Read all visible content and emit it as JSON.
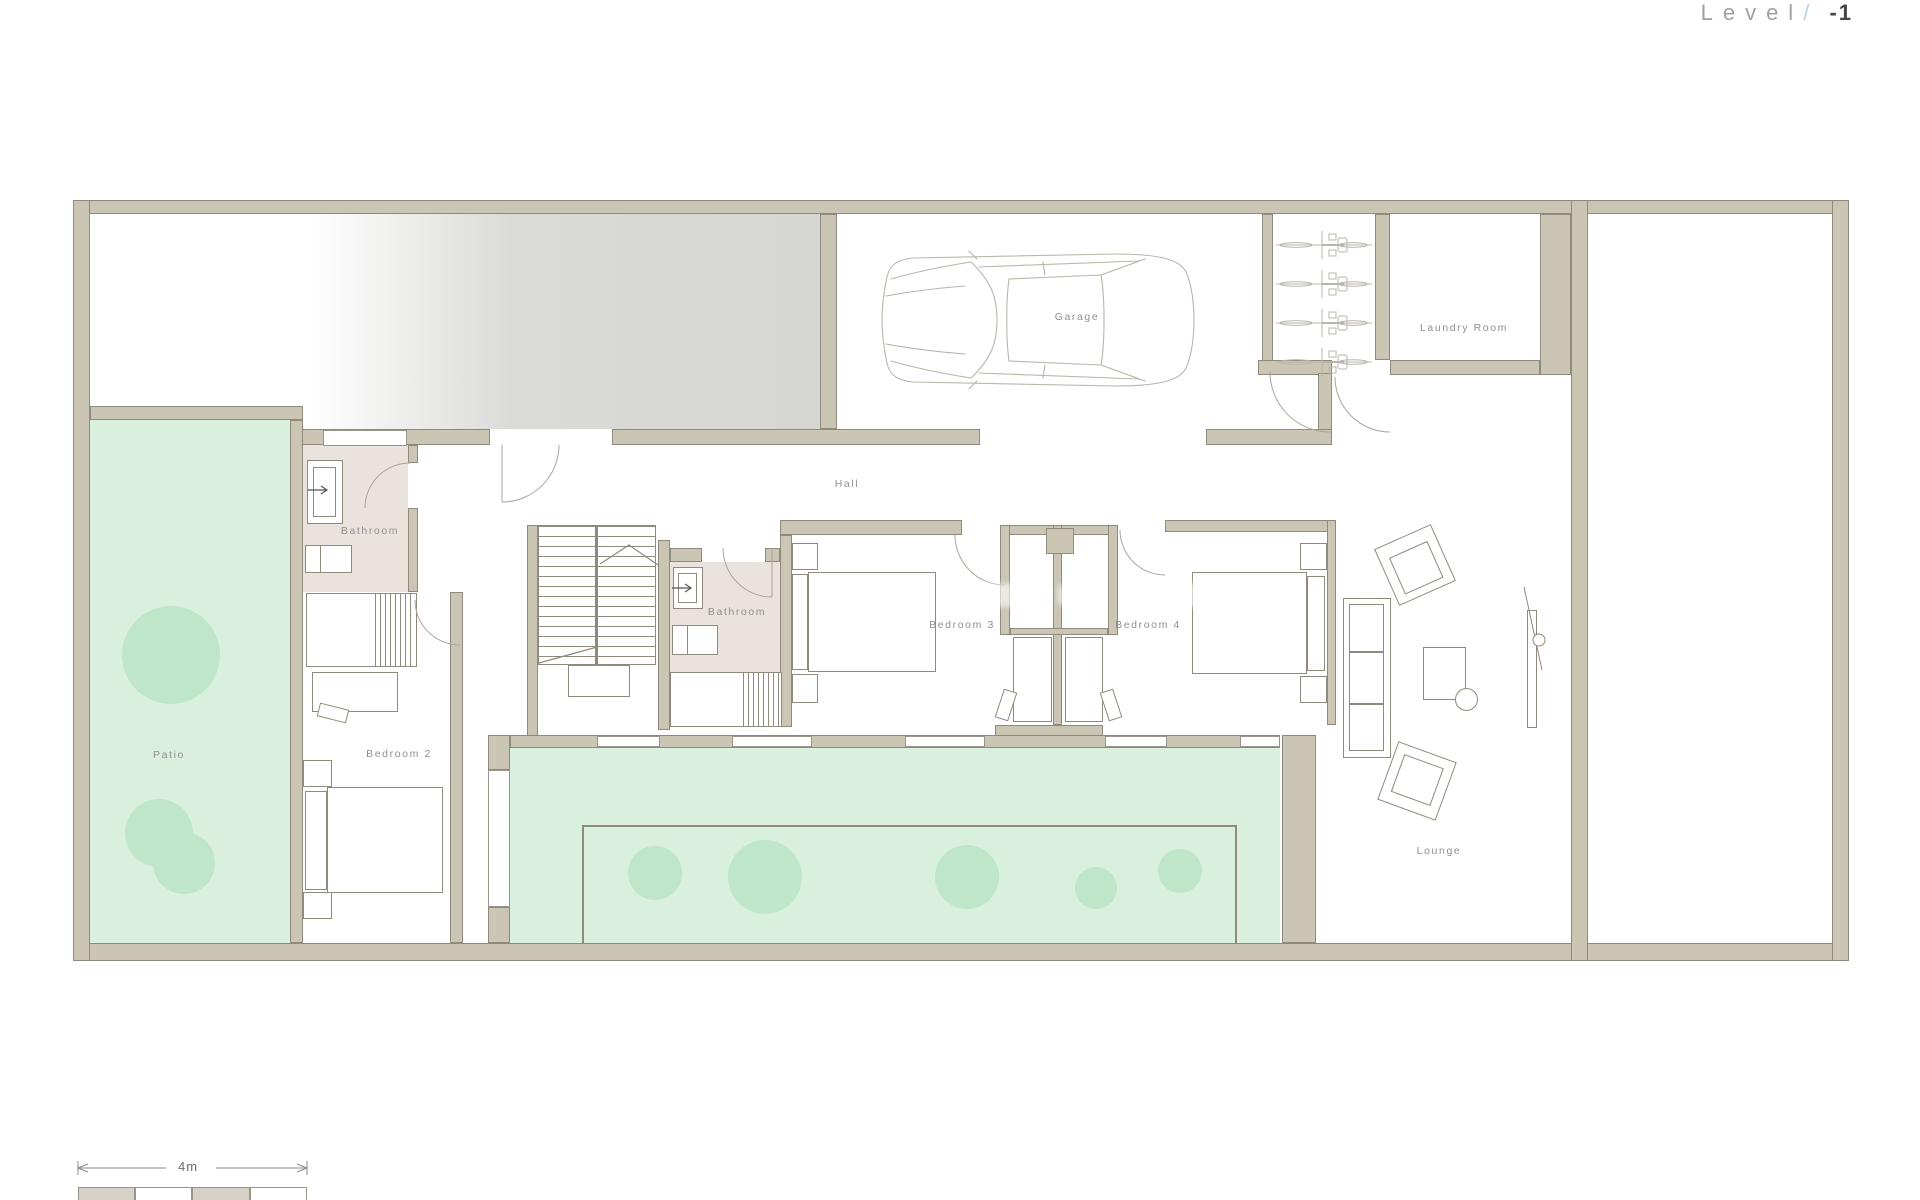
{
  "title": {
    "prefix": "Level",
    "separator": "/",
    "value": "-1"
  },
  "rooms": {
    "garage": "Garage",
    "laundry_room": "Laundry Room",
    "hall": "Hall",
    "bathroom_1": "Bathroom",
    "bathroom_2": "Bathroom",
    "bedroom_2": "Bedroom 2",
    "bedroom_3": "Bedroom 3",
    "bedroom_4": "Bedroom 4",
    "patio": "Patio",
    "lounge": "Lounge"
  },
  "scale_bar": {
    "label": "4m"
  },
  "colors": {
    "wall": "#cbc5b3",
    "wallEdge": "#8f8a7d",
    "line": "#8f8a7d",
    "floorGreen": "#d9f0de",
    "tree": "#bfe6c9",
    "bathFloor": "#eae2dc",
    "label": "#8f8f8f",
    "carLine": "#b9b5ab",
    "arcLine": "#aaa59a",
    "titleGray": "#9ba2a8",
    "titleBlue": "#b6d0de",
    "titleDark": "#43484e",
    "scaleFill": "#d6d2c7",
    "scaleLine": "#8a8a8a",
    "windowBorder": "#9a958a",
    "drivewayGray": "#d6d6d4"
  }
}
